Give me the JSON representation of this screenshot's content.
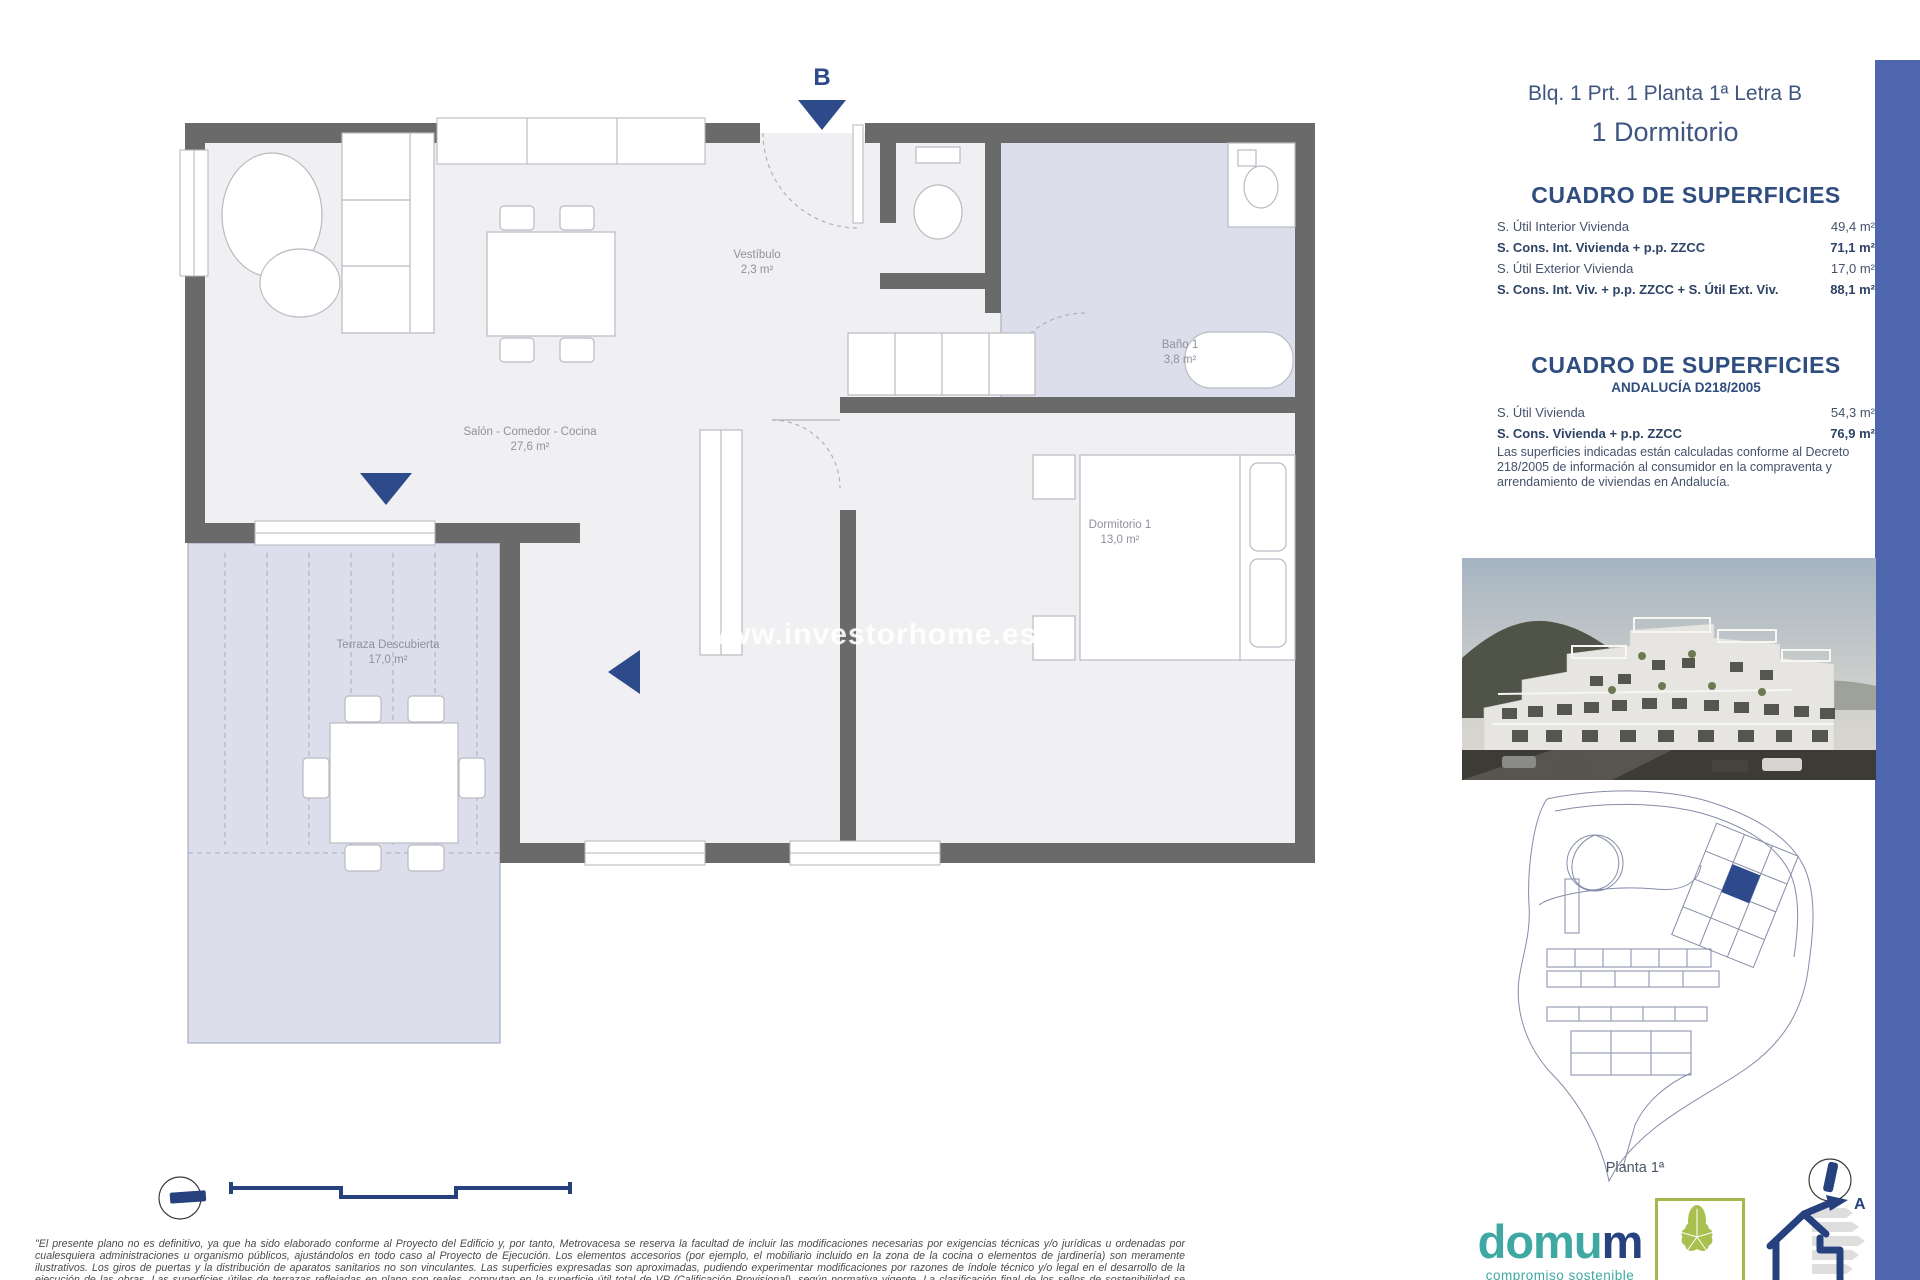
{
  "plan": {
    "section_marker": "B",
    "rooms": [
      {
        "name": "Salón - Comedor - Cocina",
        "area": "27,6 m²"
      },
      {
        "name": "Vestíbulo",
        "area": "2,3 m²"
      },
      {
        "name": "Baño 1",
        "area": "3,8 m²"
      },
      {
        "name": "Dormitorio 1",
        "area": "13,0 m²"
      },
      {
        "name": "Terraza Descubierta",
        "area": "17,0 m²"
      }
    ],
    "watermark": "www.investorhome.es"
  },
  "header": {
    "line1": "Blq. 1 Prt. 1 Planta 1ª Letra B",
    "line2": "1 Dormitorio"
  },
  "surfaces_table_1": {
    "title": "CUADRO DE SUPERFICIES",
    "rows": [
      {
        "label": "S. Útil Interior Vivienda",
        "value": "49,4 m²"
      },
      {
        "label": "S. Cons. Int. Vivienda + p.p. ZZCC",
        "value": "71,1 m²"
      },
      {
        "label": "S. Útil Exterior Vivienda",
        "value": "17,0 m²"
      },
      {
        "label": "S. Cons. Int. Viv. + p.p. ZZCC + S. Útil Ext. Viv.",
        "value": "88,1 m²"
      }
    ]
  },
  "surfaces_table_2": {
    "title": "CUADRO DE SUPERFICIES",
    "subtitle": "ANDALUCÍA D218/2005",
    "rows": [
      {
        "label": "S. Útil Vivienda",
        "value": "54,3 m²"
      },
      {
        "label": "S. Cons. Vivienda + p.p. ZZCC",
        "value": "76,9 m²"
      }
    ],
    "note": "Las superficies indicadas están calculadas conforme al Decreto 218/2005 de información al consumidor en la compraventa y arrendamiento de viviendas en Andalucía."
  },
  "site_plan": {
    "caption": "Planta 1ª"
  },
  "branding": {
    "domum_word_a": "domu",
    "domum_word_b": "m",
    "domum_tagline": "compromiso sostenible",
    "verde_label": "VERDE",
    "energy_letter": "A"
  },
  "footer": {
    "disclaimer": "\"El presente plano no es definitivo, ya que ha sido elaborado conforme al Proyecto del Edificio y, por tanto, Metrovacesa se reserva la facultad de incluir las modificaciones necesarias por exigencias técnicas y/o jurídicas u ordenadas por cualesquiera administraciones u organismo públicos, ajustándolos en todo caso al Proyecto de Ejecución. Los elementos accesorios (por ejemplo, el mobiliario incluido en la zona de la cocina o elementos de jardinería) son meramente ilustrativos. Los giros de puertas y la distribución de aparatos sanitarios no son vinculantes. Las superficies expresadas son aproximadas, pudiendo experimentar modificaciones por razones de índole técnico y/o legal en el desarrollo de la ejecución de las obras. Las superficies útiles de terrazas reflejadas en plano son reales, computan en la superficie útil total de VP (Calificación Provisional), según normativa vigente. La clasificación final de los sellos de sostenibilidad se obtendrán tras el desarrollo del Proyecto de Ejecución.\""
  },
  "colors": {
    "accent_blue_bar": "#4e66ae",
    "navy": "#27417f",
    "heading_blue": "#2f4d7f",
    "wall_gray": "#6a6a6a",
    "lavender": "#dcdeeb",
    "domum_teal": "#3fa8a3",
    "verde_olive": "#a9b54e"
  }
}
